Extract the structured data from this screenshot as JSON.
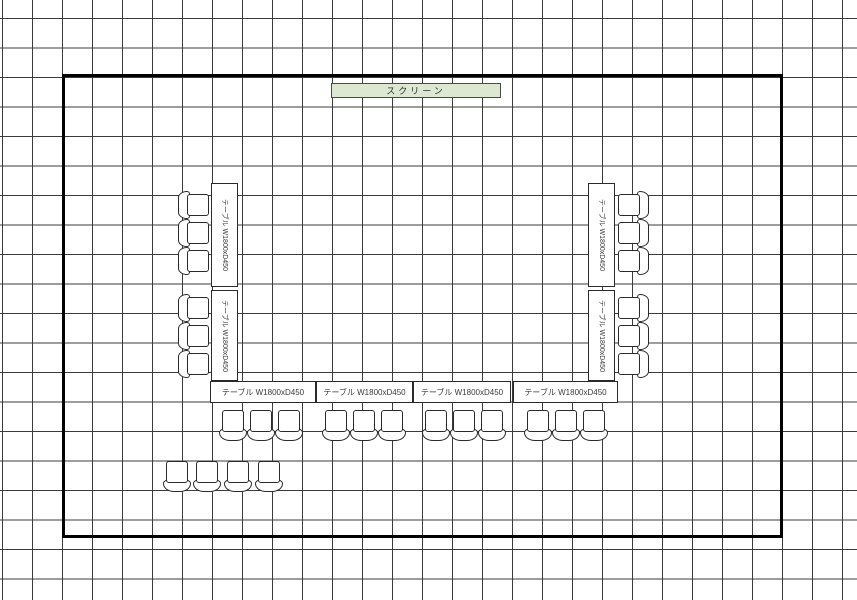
{
  "colors": {
    "grid_line": "#3b3b3b",
    "room_border": "#000000",
    "screen_fill": "#dce8d2",
    "furniture_line": "#2a2a2a"
  },
  "screen": {
    "label": "スクリーン"
  },
  "tables": {
    "items": [
      {
        "id": "left-upper",
        "label": "テーブル W1800xD450"
      },
      {
        "id": "left-lower",
        "label": "テーブル W1800xD450"
      },
      {
        "id": "right-upper",
        "label": "テーブル W1800xD450"
      },
      {
        "id": "right-lower",
        "label": "テーブル W1800xD450"
      },
      {
        "id": "bottom-1",
        "label": "テーブル W1800xD450"
      },
      {
        "id": "bottom-2",
        "label": "テーブル W1800xD450"
      },
      {
        "id": "bottom-3",
        "label": "テーブル W1800xD450"
      },
      {
        "id": "bottom-4",
        "label": "テーブル W1800xD450"
      }
    ]
  },
  "chairs": {
    "left_count": 6,
    "right_count": 6,
    "bottom_count": 12,
    "spare_count": 4,
    "total": 28
  }
}
